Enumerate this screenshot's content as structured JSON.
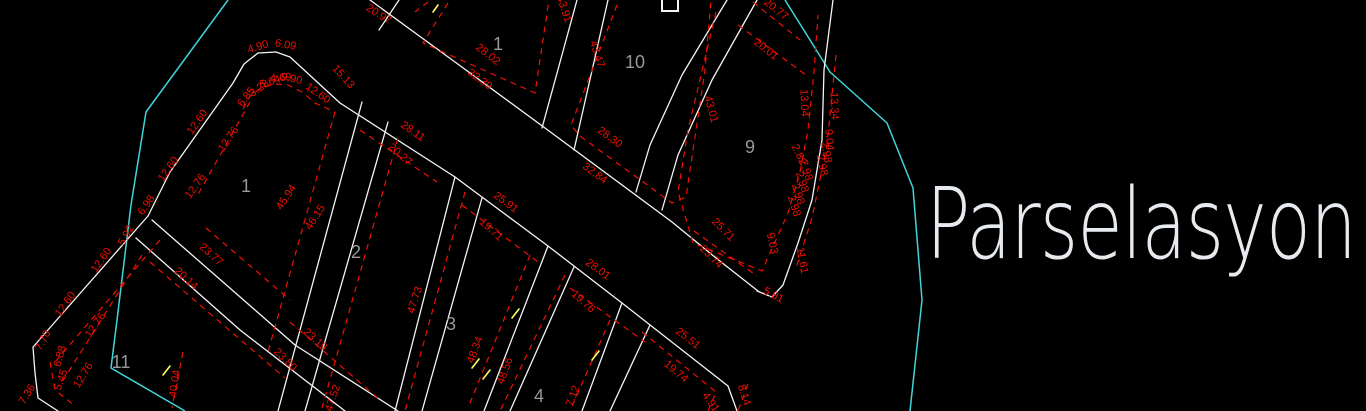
{
  "title": "Parselasyon",
  "colors": {
    "background": "#000000",
    "parcel_line": "#f5f5f5",
    "dimension_red": "#f01000",
    "boundary_cyan": "#3fd6da",
    "parcel_number_gray": "#989898",
    "tick_yellow": "#ffff5a",
    "title_white": "#e7ebf0"
  },
  "parcel_labels": [
    {
      "t": "1",
      "x": 498,
      "y": 50
    },
    {
      "t": "10",
      "x": 635,
      "y": 68
    },
    {
      "t": "9",
      "x": 750,
      "y": 153
    },
    {
      "t": "1",
      "x": 246,
      "y": 192
    },
    {
      "t": "2",
      "x": 356,
      "y": 258
    },
    {
      "t": "3",
      "x": 451,
      "y": 330
    },
    {
      "t": "4",
      "x": 539,
      "y": 402
    },
    {
      "t": "11",
      "x": 121,
      "y": 368
    }
  ],
  "dim_labels": [
    {
      "t": "20.97",
      "x": 377,
      "y": 17,
      "r": 33
    },
    {
      "t": "28.02",
      "x": 486,
      "y": 57,
      "r": 38
    },
    {
      "t": "32.39",
      "x": 478,
      "y": 82,
      "r": 36
    },
    {
      "t": "43.91",
      "x": 561,
      "y": 10,
      "r": 72
    },
    {
      "t": "43.47",
      "x": 594,
      "y": 55,
      "r": 72
    },
    {
      "t": "20.77",
      "x": 774,
      "y": 12,
      "r": 38
    },
    {
      "t": "20.01",
      "x": 764,
      "y": 52,
      "r": 38
    },
    {
      "t": "43.01",
      "x": 708,
      "y": 110,
      "r": 75
    },
    {
      "t": "13.04",
      "x": 801,
      "y": 103,
      "r": 88
    },
    {
      "t": "13.34",
      "x": 831,
      "y": 106,
      "r": 88
    },
    {
      "t": "28.30",
      "x": 608,
      "y": 140,
      "r": 36
    },
    {
      "t": "32.84",
      "x": 593,
      "y": 176,
      "r": 36
    },
    {
      "t": "15.13",
      "x": 341,
      "y": 79,
      "r": 48
    },
    {
      "t": "28.11",
      "x": 411,
      "y": 134,
      "r": 35
    },
    {
      "t": "25.91",
      "x": 504,
      "y": 205,
      "r": 36
    },
    {
      "t": "28.01",
      "x": 596,
      "y": 272,
      "r": 36
    },
    {
      "t": "25.51",
      "x": 686,
      "y": 341,
      "r": 38
    },
    {
      "t": "8.14",
      "x": 741,
      "y": 396,
      "r": 72
    },
    {
      "t": "4.91",
      "x": 708,
      "y": 404,
      "r": 55
    },
    {
      "t": "19.74",
      "x": 674,
      "y": 374,
      "r": 40
    },
    {
      "t": "19.76",
      "x": 581,
      "y": 304,
      "r": 42
    },
    {
      "t": "19.71",
      "x": 489,
      "y": 232,
      "r": 42
    },
    {
      "t": "20.27",
      "x": 398,
      "y": 157,
      "r": 42
    },
    {
      "t": "23.77",
      "x": 209,
      "y": 257,
      "r": 42
    },
    {
      "t": "20.14",
      "x": 184,
      "y": 281,
      "r": 42
    },
    {
      "t": "23.80",
      "x": 283,
      "y": 362,
      "r": 45
    },
    {
      "t": "23.19",
      "x": 313,
      "y": 342,
      "r": 42
    },
    {
      "t": "45.94",
      "x": 289,
      "y": 199,
      "r": -57
    },
    {
      "t": "46.15",
      "x": 318,
      "y": 219,
      "r": -57
    },
    {
      "t": "47.52",
      "x": 336,
      "y": 399,
      "r": -72
    },
    {
      "t": "47.73",
      "x": 418,
      "y": 301,
      "r": -72
    },
    {
      "t": "48.34",
      "x": 478,
      "y": 351,
      "r": -70
    },
    {
      "t": "48.56",
      "x": 508,
      "y": 372,
      "r": -70
    },
    {
      "t": "7.12",
      "x": 576,
      "y": 397,
      "r": -70
    },
    {
      "t": "40.04",
      "x": 178,
      "y": 384,
      "r": -82
    },
    {
      "t": "12.60",
      "x": 200,
      "y": 124,
      "r": -55
    },
    {
      "t": "12.76",
      "x": 231,
      "y": 141,
      "r": -55
    },
    {
      "t": "12.60",
      "x": 171,
      "y": 171,
      "r": -55
    },
    {
      "t": "12.76",
      "x": 198,
      "y": 188,
      "r": -55
    },
    {
      "t": "6.98",
      "x": 149,
      "y": 207,
      "r": -55
    },
    {
      "t": "5.92",
      "x": 129,
      "y": 237,
      "r": -60
    },
    {
      "t": "12.60",
      "x": 104,
      "y": 262,
      "r": -55
    },
    {
      "t": "12.76",
      "x": 98,
      "y": 327,
      "r": -55
    },
    {
      "t": "12.60",
      "x": 68,
      "y": 306,
      "r": -55
    },
    {
      "t": "12.76",
      "x": 86,
      "y": 377,
      "r": -58
    },
    {
      "t": "7.70",
      "x": 46,
      "y": 342,
      "r": -62
    },
    {
      "t": "7.36",
      "x": 30,
      "y": 396,
      "r": -58
    },
    {
      "t": "6.88",
      "x": 63,
      "y": 357,
      "r": -75
    },
    {
      "t": "5.45",
      "x": 64,
      "y": 381,
      "r": -70
    },
    {
      "t": "4.90",
      "x": 259,
      "y": 50,
      "r": -18
    },
    {
      "t": "6.09",
      "x": 285,
      "y": 48,
      "r": 10
    },
    {
      "t": "6.85",
      "x": 249,
      "y": 99,
      "r": -52
    },
    {
      "t": "3.28",
      "x": 261,
      "y": 91,
      "r": -35
    },
    {
      "t": "5.64",
      "x": 271,
      "y": 85,
      "r": -18
    },
    {
      "t": "4.69",
      "x": 281,
      "y": 81,
      "r": -5
    },
    {
      "t": "9.90",
      "x": 291,
      "y": 82,
      "r": 12
    },
    {
      "t": "12.60",
      "x": 316,
      "y": 96,
      "r": 35
    },
    {
      "t": "25.71",
      "x": 721,
      "y": 232,
      "r": 45
    },
    {
      "t": "23.74",
      "x": 709,
      "y": 259,
      "r": 45
    },
    {
      "t": "9.03",
      "x": 769,
      "y": 244,
      "r": 78
    },
    {
      "t": "11.61",
      "x": 799,
      "y": 261,
      "r": 80
    },
    {
      "t": "5.81",
      "x": 772,
      "y": 298,
      "r": 28
    },
    {
      "t": "2.82",
      "x": 796,
      "y": 156,
      "r": 65
    },
    {
      "t": "2.98",
      "x": 791,
      "y": 207,
      "r": 72
    },
    {
      "t": "2.98",
      "x": 795,
      "y": 195,
      "r": 72
    },
    {
      "t": "2.98",
      "x": 799,
      "y": 183,
      "r": 72
    },
    {
      "t": "2.98",
      "x": 803,
      "y": 171,
      "r": 73
    },
    {
      "t": "2.98",
      "x": 819,
      "y": 166,
      "r": 78
    },
    {
      "t": "2.98",
      "x": 823,
      "y": 153,
      "r": 80
    },
    {
      "t": "9.04",
      "x": 826,
      "y": 140,
      "r": 85
    }
  ]
}
